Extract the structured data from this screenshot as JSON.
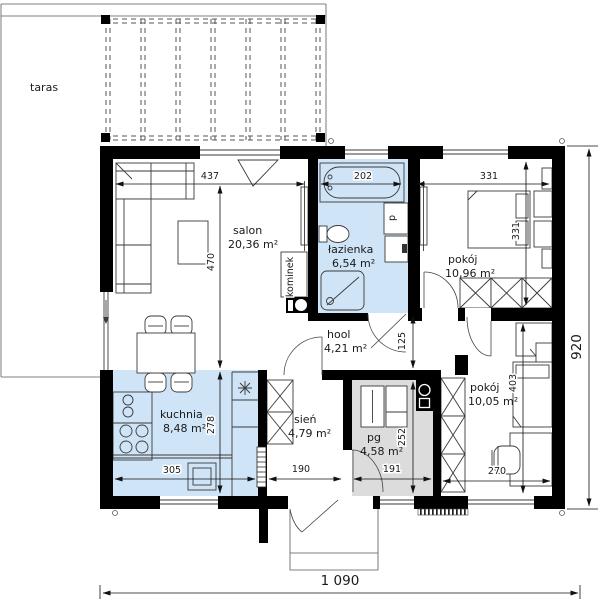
{
  "rooms": {
    "taras": {
      "label": "taras"
    },
    "salon": {
      "label": "salon",
      "area": "20,36 m²"
    },
    "lazienka": {
      "label": "łazienka",
      "area": "6,54 m²"
    },
    "pokoj_gorny": {
      "label": "pokój",
      "area": "10,96 m²"
    },
    "hool": {
      "label": "hool",
      "area": "4,21 m²"
    },
    "kuchnia": {
      "label": "kuchnia",
      "area": "8,48 m²"
    },
    "sien": {
      "label": "sień",
      "area": "4,79 m²"
    },
    "pg": {
      "label": "pg",
      "area": "4,58 m²"
    },
    "pokoj_dolny": {
      "label": "pokój",
      "area": "10,05 m²"
    }
  },
  "fixtures": {
    "kominek": "kominek",
    "pralka": "p"
  },
  "dimensions": {
    "salon_width": "437",
    "salon_height": "470",
    "lazienka_width": "202",
    "pokoj_gorny_width": "331",
    "pokoj_gorny_height": "331",
    "hool_height": "125",
    "kuchnia_width": "305",
    "kuchnia_height": "278",
    "sien_width": "190",
    "pg_width": "191",
    "pg_height": "252",
    "pokoj_dolny_width": "270",
    "pokoj_dolny_height": "403",
    "house_depth": "920",
    "house_width": "1 090"
  },
  "colors": {
    "wet_room_fill": "#cfe4f6",
    "utility_fill": "#dcdcdc",
    "wall": "#000000"
  }
}
